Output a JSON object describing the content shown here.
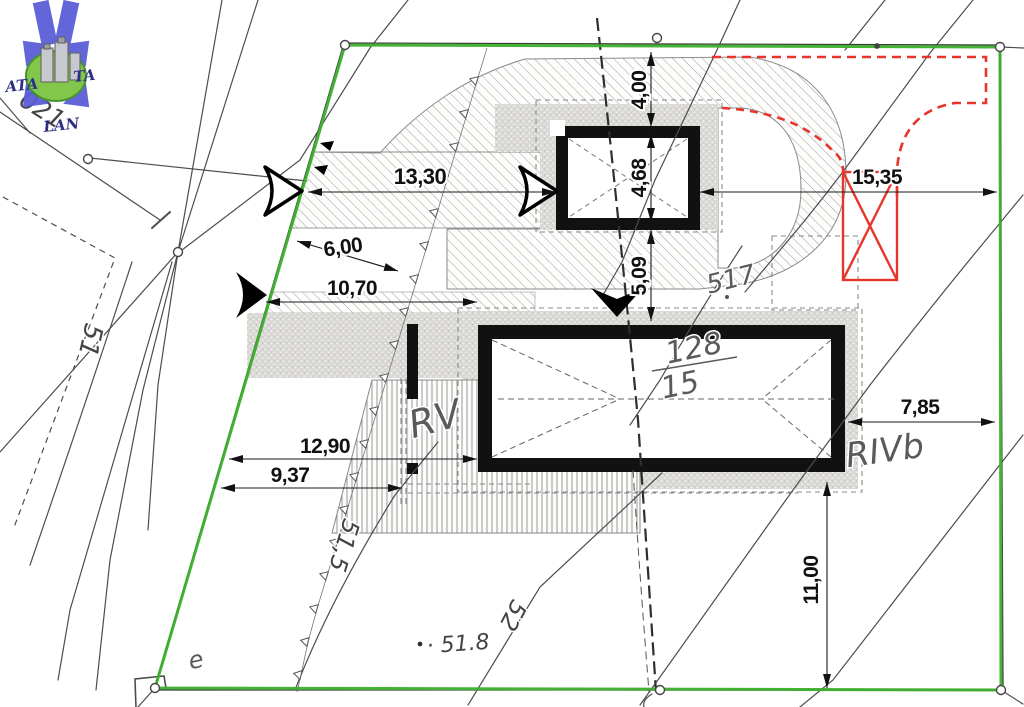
{
  "drawing": {
    "type": "cadastral site plan",
    "boundary_color": "#3cae2c",
    "highlight_color": "#e8352b"
  },
  "logo": {
    "left": "ATA",
    "right": "TA",
    "bottom": "LAN"
  },
  "dimensions": {
    "driveway_length": "13,30",
    "boundary_to_driveway": "6,00",
    "boundary_to_house": "10,70",
    "boundary_to_house_south": "12,90",
    "boundary_to_terrace": "9,37",
    "boundary_to_garage": "4,00",
    "garage_depth": "4,68",
    "garage_to_house": "5,09",
    "garage_to_east_boundary": "15,35",
    "house_to_east_boundary": "7,85",
    "house_to_south_boundary": "11,00"
  },
  "labels": {
    "parcel_number": "128",
    "parcel_denominator": "15",
    "neighbour_parcel": "517",
    "zone_rv": "RV",
    "zone_rivb": "RIVb",
    "contour_51_5": "51,5",
    "contour_52": "52",
    "contour_51": "51",
    "boundary_point": "021",
    "spot_elevation": "· 51.8",
    "point_e": "e"
  }
}
